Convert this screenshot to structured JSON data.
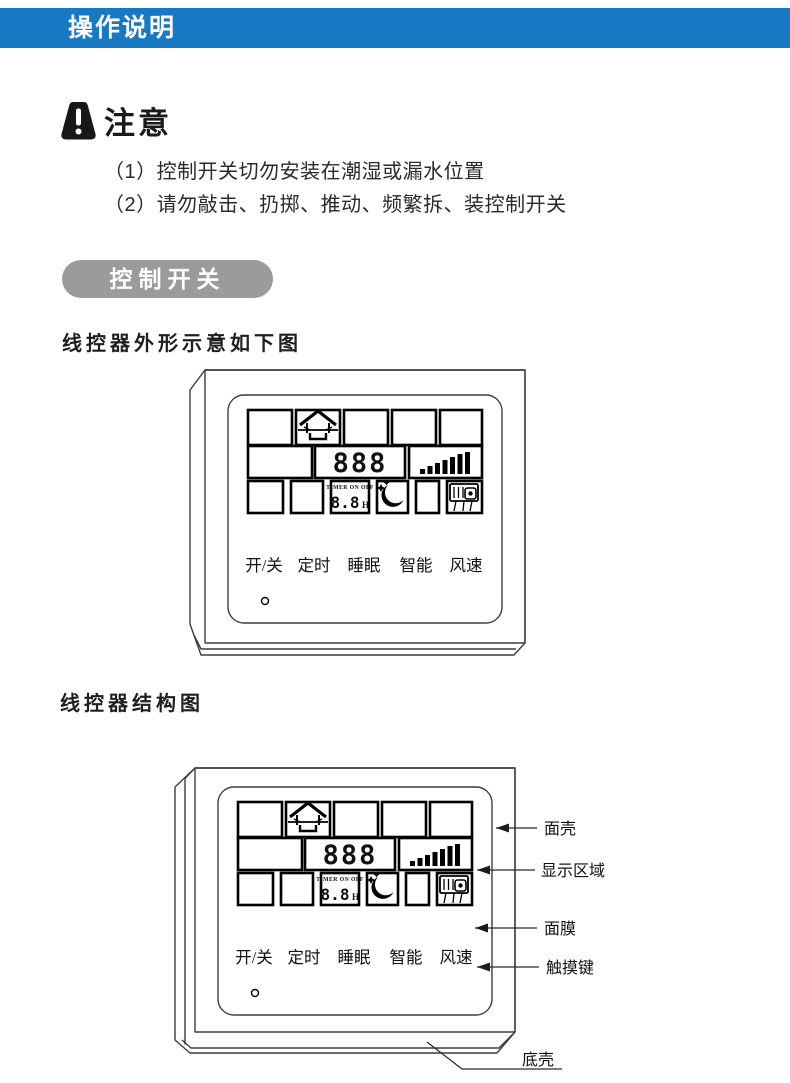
{
  "header": {
    "title": "操作说明"
  },
  "notice": {
    "title": "注意",
    "icon": "warning-icon",
    "items": [
      "（1）控制开关切勿安装在潮湿或漏水位置",
      "（2）请勿敲击、扔掷、推动、频繁拆、装控制开关"
    ]
  },
  "section": {
    "banner": "控制开关"
  },
  "figure1": {
    "caption": "线控器外形示意如下图"
  },
  "figure2": {
    "caption": "线控器结构图",
    "callouts": [
      "面壳",
      "显示区域",
      "面膜",
      "触摸键",
      "底壳"
    ]
  },
  "controller": {
    "buttons": [
      "开/关",
      "定时",
      "睡眠",
      "智能",
      "风速"
    ],
    "display": {
      "temp_digits": "888",
      "timer_label": "TIMER ON OFF",
      "timer_digits": "8.8",
      "timer_unit": "H",
      "icons": [
        "house-icon",
        "fan-speed-bars-icon",
        "moon-stars-sleep-icon",
        "fan-coil-unit-icon",
        "power-led"
      ]
    }
  },
  "colors": {
    "header_bg": "#1778c4",
    "header_text": "#ffffff",
    "banner_bg": "#9b9b9b",
    "line_color": "#3d3d3d",
    "text_color": "#231f20"
  }
}
